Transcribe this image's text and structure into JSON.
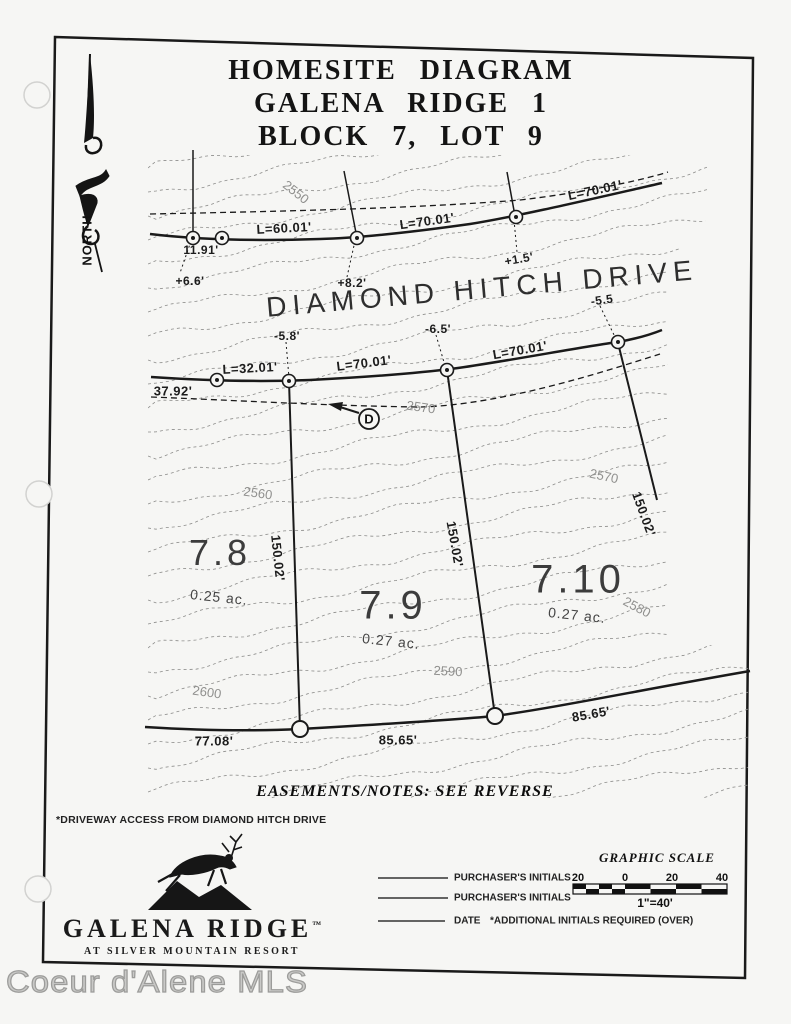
{
  "page": {
    "title_lines": [
      "HOMESITE DIAGRAM",
      "GALENA RIDGE 1",
      "BLOCK 7, LOT 9"
    ]
  },
  "map": {
    "street_name": "DIAMOND HITCH DRIVE",
    "north_label": "NORTH",
    "driveway_marker": "D",
    "labels": [
      {
        "name": "len-l-60-01",
        "text": "L=60.01'",
        "x": 284,
        "y": 228,
        "rot": -3,
        "fs": 13,
        "cls": "dim"
      },
      {
        "name": "len-l-70-01-a",
        "text": "L=70.01'",
        "x": 427,
        "y": 221,
        "rot": -8,
        "fs": 13,
        "cls": "dim"
      },
      {
        "name": "len-l-70-01-b",
        "text": "L=70.01'",
        "x": 595,
        "y": 190,
        "rot": -12,
        "fs": 13,
        "cls": "dim"
      },
      {
        "name": "offset-11-91",
        "text": "11.91'",
        "x": 201,
        "y": 250,
        "rot": 0,
        "fs": 12,
        "cls": "dim"
      },
      {
        "name": "offset-plus-6-6",
        "text": "+6.6'",
        "x": 190,
        "y": 281,
        "rot": 0,
        "fs": 12,
        "cls": "dim"
      },
      {
        "name": "offset-plus-8-2",
        "text": "+8.2'",
        "x": 352,
        "y": 283,
        "rot": 0,
        "fs": 12,
        "cls": "dim"
      },
      {
        "name": "offset-plus-1-5",
        "text": "+1.5'",
        "x": 519,
        "y": 259,
        "rot": -10,
        "fs": 12,
        "cls": "dim"
      },
      {
        "name": "offset-minus-5-5",
        "text": "-5.5",
        "x": 602,
        "y": 300,
        "rot": -8,
        "fs": 12,
        "cls": "dim"
      },
      {
        "name": "offset-minus-5-8",
        "text": "-5.8'",
        "x": 287,
        "y": 336,
        "rot": 0,
        "fs": 12,
        "cls": "dim"
      },
      {
        "name": "offset-minus-6-5",
        "text": "-6.5'",
        "x": 438,
        "y": 329,
        "rot": 0,
        "fs": 12,
        "cls": "dim"
      },
      {
        "name": "len-l-32-01",
        "text": "L=32.01'",
        "x": 250,
        "y": 368,
        "rot": -3,
        "fs": 13,
        "cls": "dim"
      },
      {
        "name": "len-l-70-01-c",
        "text": "L=70.01'",
        "x": 364,
        "y": 363,
        "rot": -7,
        "fs": 13,
        "cls": "dim"
      },
      {
        "name": "len-l-70-01-d",
        "text": "L=70.01'",
        "x": 520,
        "y": 350,
        "rot": -10,
        "fs": 13,
        "cls": "dim"
      },
      {
        "name": "dist-37-92",
        "text": "37.92'",
        "x": 173,
        "y": 391,
        "rot": 0,
        "fs": 13,
        "cls": "dim"
      },
      {
        "name": "dist-150-02-a",
        "text": "150.02'",
        "x": 278,
        "y": 558,
        "rot": 84,
        "fs": 13,
        "cls": "dim"
      },
      {
        "name": "dist-150-02-b",
        "text": "150.02'",
        "x": 455,
        "y": 544,
        "rot": 80,
        "fs": 13,
        "cls": "dim"
      },
      {
        "name": "dist-150-02-c",
        "text": "150.02'",
        "x": 644,
        "y": 514,
        "rot": 70,
        "fs": 13,
        "cls": "dim"
      },
      {
        "name": "dist-77-08",
        "text": "77.08'",
        "x": 214,
        "y": 741,
        "rot": 0,
        "fs": 13,
        "cls": "dim"
      },
      {
        "name": "dist-85-65-a",
        "text": "85.65'",
        "x": 398,
        "y": 740,
        "rot": 0,
        "fs": 13,
        "cls": "dim"
      },
      {
        "name": "dist-85-65-b",
        "text": "85.65'",
        "x": 591,
        "y": 714,
        "rot": -10,
        "fs": 13,
        "cls": "dim"
      },
      {
        "name": "contour-2550",
        "text": "2550",
        "x": 296,
        "y": 192,
        "rot": 38,
        "fs": 13,
        "cls": "contour"
      },
      {
        "name": "contour-2570-a",
        "text": "2570",
        "x": 421,
        "y": 407,
        "rot": 8,
        "fs": 13,
        "cls": "contour"
      },
      {
        "name": "contour-2560",
        "text": "2560",
        "x": 258,
        "y": 493,
        "rot": 8,
        "fs": 13,
        "cls": "contour"
      },
      {
        "name": "contour-2570-b",
        "text": "2570",
        "x": 604,
        "y": 476,
        "rot": 12,
        "fs": 13,
        "cls": "contour"
      },
      {
        "name": "contour-2580",
        "text": "2580",
        "x": 637,
        "y": 607,
        "rot": 28,
        "fs": 13,
        "cls": "contour"
      },
      {
        "name": "contour-2590",
        "text": "2590",
        "x": 448,
        "y": 671,
        "rot": 3,
        "fs": 13,
        "cls": "contour"
      },
      {
        "name": "contour-2600",
        "text": "2600",
        "x": 207,
        "y": 692,
        "rot": 8,
        "fs": 13,
        "cls": "contour"
      },
      {
        "name": "lot-number-7-8",
        "text": "7.8",
        "x": 220,
        "y": 553,
        "rot": 0,
        "fs": 36,
        "cls": "lot"
      },
      {
        "name": "lot-number-7-9",
        "text": "7.9",
        "x": 393,
        "y": 606,
        "rot": 0,
        "fs": 40,
        "cls": "lot"
      },
      {
        "name": "lot-number-7-10",
        "text": "7.10",
        "x": 578,
        "y": 580,
        "rot": 0,
        "fs": 40,
        "cls": "lot"
      },
      {
        "name": "lot-acreage-7-8",
        "text": "0.25 ac.",
        "x": 219,
        "y": 597,
        "rot": 6,
        "fs": 14,
        "cls": "acre"
      },
      {
        "name": "lot-acreage-7-9",
        "text": "0.27 ac.",
        "x": 391,
        "y": 641,
        "rot": 6,
        "fs": 14,
        "cls": "acre"
      },
      {
        "name": "lot-acreage-7-10",
        "text": "0.27 ac.",
        "x": 577,
        "y": 615,
        "rot": 6,
        "fs": 14,
        "cls": "acre"
      }
    ]
  },
  "notes": {
    "easements": "EASEMENTS/NOTES: SEE REVERSE",
    "driveway_access": "*DRIVEWAY ACCESS FROM DIAMOND HITCH DRIVE",
    "additional_initials": "*ADDITIONAL INITIALS REQUIRED (OVER)"
  },
  "signature_block": {
    "lines": [
      "PURCHASER'S INITIALS",
      "PURCHASER'S INITIALS",
      "DATE"
    ]
  },
  "scale": {
    "title": "GRAPHIC SCALE",
    "ticks": [
      "20",
      "0",
      "20",
      "40"
    ],
    "ratio": "1\"=40'"
  },
  "branding": {
    "name": "GALENA RIDGE",
    "tm": "™",
    "tagline": "AT SILVER MOUNTAIN RESORT"
  },
  "watermark": {
    "text": "Coeur d'Alene MLS"
  }
}
